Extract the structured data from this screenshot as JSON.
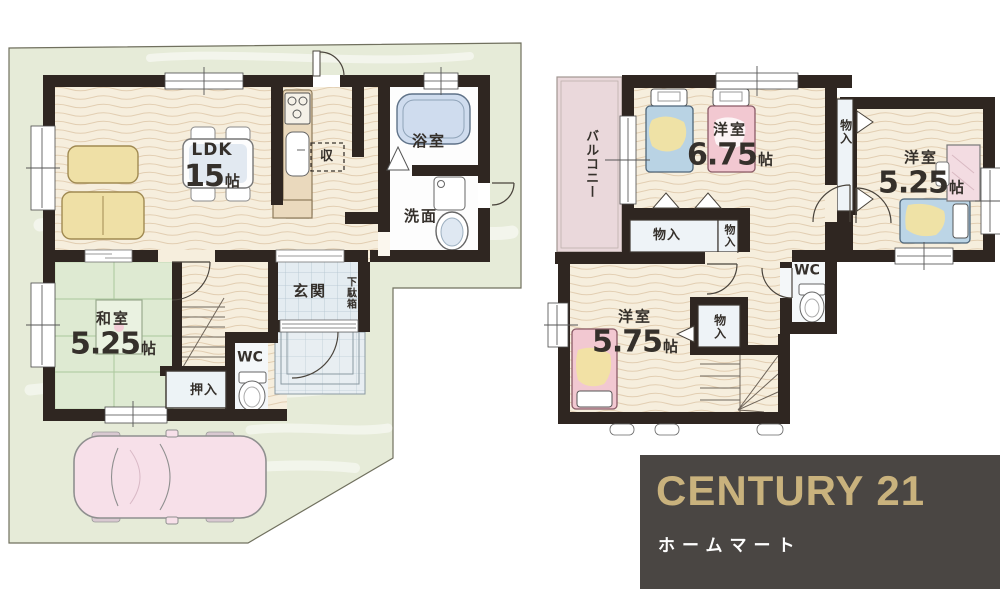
{
  "floor1": {
    "ldk": "LDK",
    "ldk_size": "15",
    "ldk_unit": "帖",
    "pantry": "収",
    "bath": "浴室",
    "washroom": "洗面",
    "entrance": "玄関",
    "shoebox": "下駄箱",
    "tatami_room": "和室",
    "tatami_size": "5.25",
    "tatami_unit": "帖",
    "oshiire": "押入",
    "wc": "WC"
  },
  "floor2": {
    "balcony": "バルコニー",
    "room1": "洋室",
    "room1_size": "6.75",
    "room1_unit": "帖",
    "room2": "洋室",
    "room2_size": "5.25",
    "room2_unit": "帖",
    "room3": "洋室",
    "room3_size": "5.75",
    "room3_unit": "帖",
    "storage1": "物入",
    "storage2": "物入",
    "storage3": "物入",
    "storage4": "物入",
    "wc": "WC"
  },
  "logo": {
    "brand": "CENTURY 21",
    "company": "ホームマート",
    "background_color": "#4a4643",
    "brand_color": "#c9b27d"
  },
  "colors": {
    "wall": "#2f2621",
    "site_green": "#e6ebd8",
    "floor_cream": "#f6eedd",
    "tatami_green": "#deead2",
    "balcony_pink": "#ead8db",
    "car_pink": "#f7e0e9"
  }
}
